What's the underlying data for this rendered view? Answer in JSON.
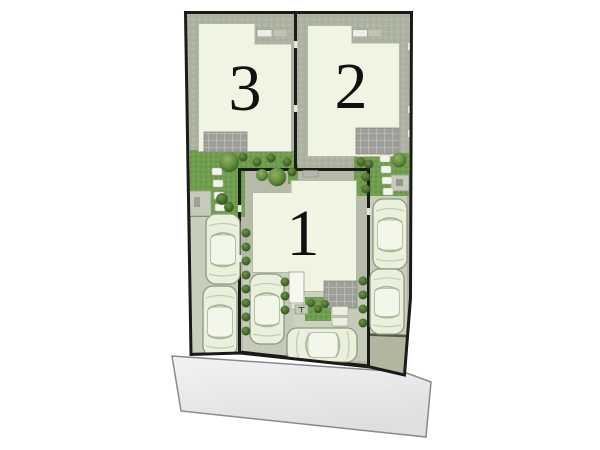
{
  "plan": {
    "title": "three-lot residential site plan",
    "lots": [
      {
        "number": "1"
      },
      {
        "number": "2"
      },
      {
        "number": "3"
      }
    ]
  },
  "colors": {
    "background": "#ffffff",
    "ground": "#adb2a1",
    "lawn": "#6f9e4c",
    "house_fill": "#f0f4e2",
    "house_stroke": "#b2b8a4",
    "tile_grey": "#9d9f98",
    "road_fill": "#e7e7e9",
    "road_stroke": "#8a8a8d",
    "border_black": "#1a1a18",
    "car_body": "#eaf0db",
    "parking_concrete": "#c9cdbb",
    "apron": "#b2b59f",
    "tree_dark": "#33551f"
  }
}
